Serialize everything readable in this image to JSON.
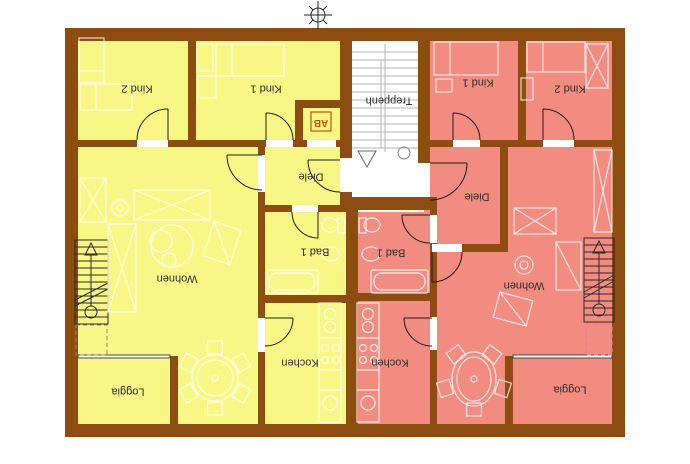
{
  "labels": {
    "left": {
      "kind2": "Kind 2",
      "kind1": "Kind 1",
      "ab": "AB",
      "diele": "Diele",
      "bad": "Bad 1",
      "wohnen": "Wohnen",
      "kochen": "Kochen",
      "loggia": "Loggia"
    },
    "right": {
      "kind1": "Kind 1",
      "kind2": "Kind 2",
      "diele": "Diele",
      "bad": "Bad 1",
      "wohnen": "Wohnen",
      "kochen": "Kochen",
      "loggia": "Loggia"
    },
    "stairwell": "Treppenh"
  },
  "colors": {
    "wall": "#8d4c10",
    "left_apartment": "#f8f786",
    "right_apartment": "#f28b80",
    "stairwell": "#ffffff",
    "ab_accent": "#c45500"
  }
}
